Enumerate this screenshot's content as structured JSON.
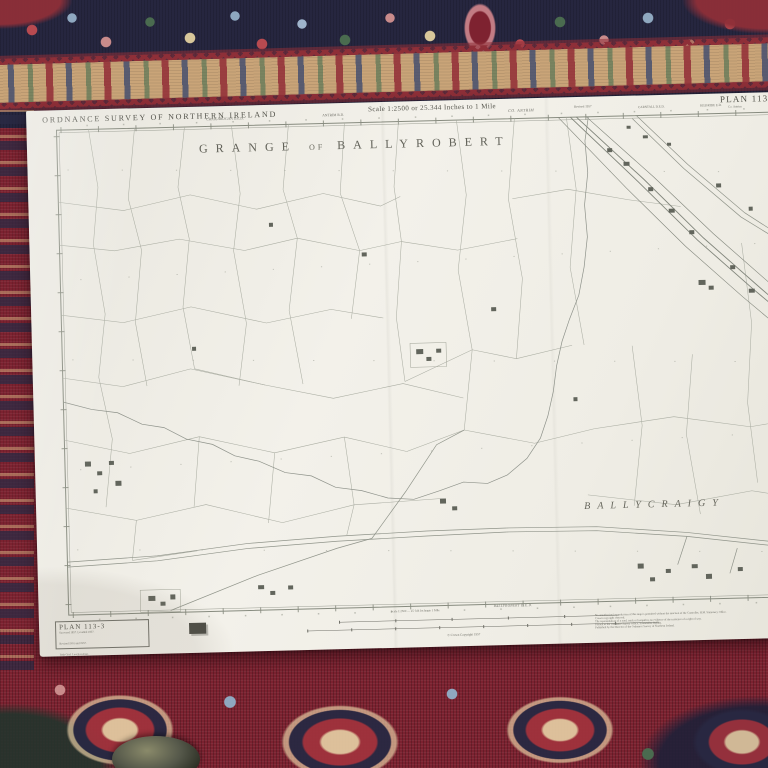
{
  "map": {
    "header": {
      "agency": "ORDNANCE SURVEY OF NORTHERN IRELAND",
      "ded_left": "CRAIGAROGAN D.E.D.",
      "rd_left": "ANTRIM R.D.",
      "scale_statement": "Scale 1:2500 or 25.344 Inches to 1 Mile",
      "county": "CO. ANTRIM",
      "revised": "Revised 1957",
      "ded_right": "CARNTALL D.E.D.",
      "ed_right": "KILBRIDE E.D.",
      "plan_label": "PLAN 113-3",
      "plan_sub": "Co. Antrim"
    },
    "labels": {
      "grange_1": "GRANGE",
      "grange_of": "OF",
      "grange_2": "BALLYROBERT",
      "ballycraigy": "BALLYCRAIGY"
    },
    "footer": {
      "plan_title": "PLAN 113-3",
      "plan_lines": [
        "Surveyed 1857.  Levelled 1857.",
        "Revised 1901 and 1957.",
        "Irish Grid.  Levels in Feet."
      ],
      "ded_bottom": "BALLYROBERT D.E.D.",
      "bar_caption": "Scale 1:2500 — 25·344 Inches to 1 Mile",
      "crown": "© Crown Copyright 1957",
      "notes": [
        "No unauthorised reproduction of this map is permitted without the sanction of the Controller, H.M. Stationery Office.",
        "Crown copyright reserved.",
        "The representation of a road, track or footpath is no evidence of the existence of a right of way.",
        "Printed at the Ordnance Survey Office, Stranmillis, Belfast.",
        "Published by the Director of the Ordnance Survey of Northern Ireland."
      ]
    }
  }
}
